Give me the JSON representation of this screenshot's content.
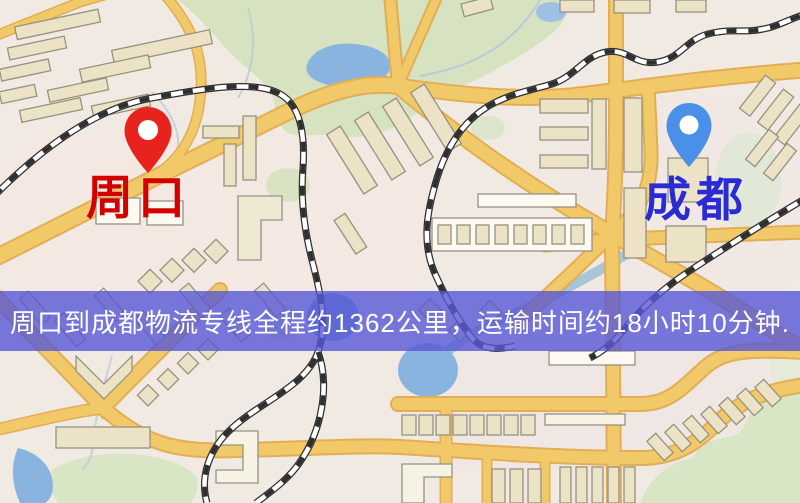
{
  "map": {
    "origin": {
      "city": "周口",
      "label_color": "#d40000",
      "pin_color": "#e8221c"
    },
    "destination": {
      "city": "成都",
      "label_color": "#2b2bd4",
      "pin_color": "#4a90e8"
    },
    "banner": {
      "text": "周口到成都物流专线全程约1362公里，运输时间约18小时10分钟.",
      "distance": "约1362公里",
      "duration": "约18小时10分钟",
      "background_color": "#5858d6",
      "text_color": "#ffffff"
    },
    "style_colors": {
      "road": "#f2c968",
      "road_casing": "#e2ae55",
      "water": "#8ab4e0",
      "park": "#d8e3c4",
      "building": "#ece3c6",
      "railway": "black-white-dashed"
    }
  }
}
